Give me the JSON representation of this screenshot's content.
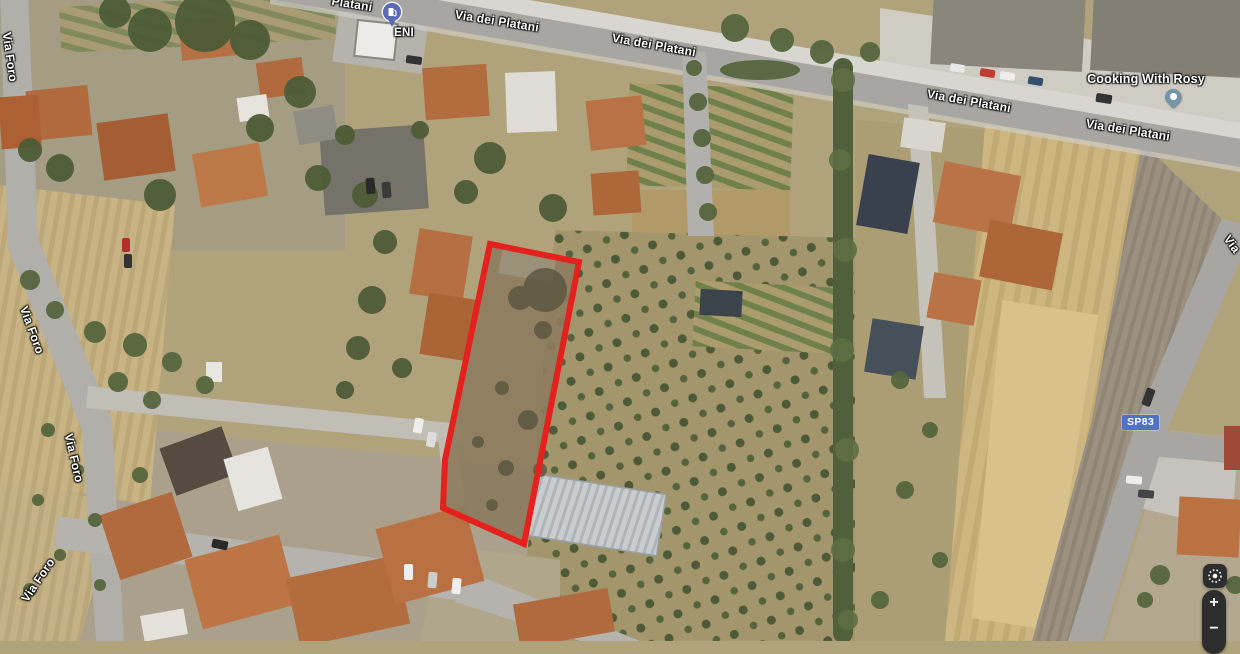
{
  "map": {
    "road_labels": [
      {
        "text": "Platani"
      },
      {
        "text": "Via dei Platani"
      },
      {
        "text": "Via dei Platani"
      },
      {
        "text": "Via dei Platani"
      },
      {
        "text": "Via dei Platani"
      },
      {
        "text": "Via Foro"
      },
      {
        "text": "Via Foro"
      },
      {
        "text": "Via Foro"
      },
      {
        "text": "Via Foro"
      },
      {
        "text": "Via"
      }
    ],
    "pois": [
      {
        "name": "ENI",
        "type": "gas-station",
        "pin_color": "#5c6bb5"
      },
      {
        "name": "Cooking With Rosy",
        "type": "place",
        "pin_color": "#7495a5"
      }
    ],
    "route_badge": {
      "text": "SP83",
      "color": "#4f72c4"
    },
    "parcel_outline": {
      "color": "#e5211d",
      "stroke_width": 6
    },
    "controls": {
      "zoom_in": "+",
      "zoom_out": "−"
    }
  }
}
